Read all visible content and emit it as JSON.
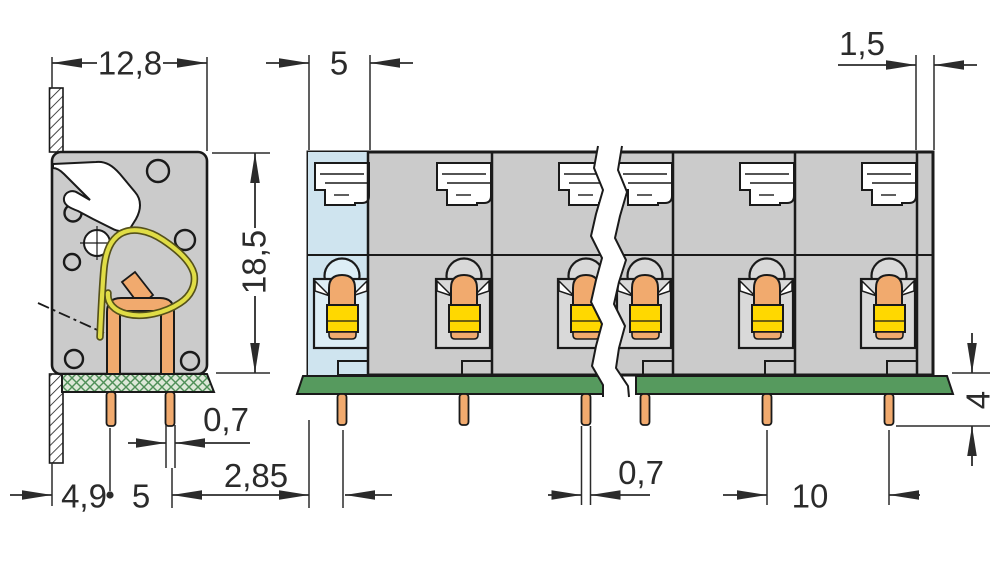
{
  "drawing": {
    "type": "technical dimension drawing",
    "subject": "PCB screw-less terminal block — side section view and multi-pole front view",
    "unit": "mm"
  },
  "dims": {
    "side_overall_width": "12,8",
    "front_cell_width": "5",
    "front_edge_margin": "1,5",
    "side_height": "18,5",
    "side_pin_width": "0,7",
    "side_pin_to_face": "2,85",
    "side_wall_to_pin": "4,9",
    "side_pin_spacing": "5",
    "front_pin_width": "0,7",
    "front_pin_pitch": "10",
    "pin_length_below_pcb": "4"
  },
  "colors": {
    "body_gray": "#cbcbcb",
    "box_gray": "#d9d9d9",
    "blue_cell": "#cfe4ef",
    "blue_box": "#ddeef6",
    "pcb_green": "#569a5e",
    "pcb_side_bg": "#dde8d8",
    "pcb_side_hatch": "#4e8f57",
    "copper": "#f1aa6e",
    "yellow": "#ffd800",
    "spring": "#e0dd46",
    "spring_dark": "#55511a",
    "outline": "#1a1a1a",
    "dim": "#2b2b2b"
  }
}
